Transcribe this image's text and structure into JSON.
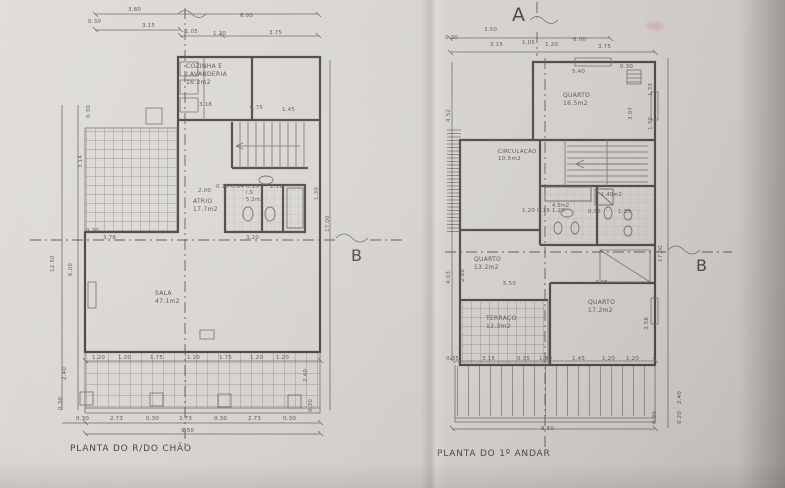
{
  "left_plan": {
    "title": "PLANTA DO R/DO CHÃO",
    "rooms": {
      "cozinha": {
        "name1": "COZINHA E",
        "name2": "LAVANDERIA",
        "area": "16.2m2"
      },
      "atrio": {
        "name1": "ATRIO",
        "area": "17.7m2"
      },
      "sala": {
        "name1": "SALA",
        "area": "47.1m2"
      },
      "instalacao_sanitaria": {
        "name1": "I.S.",
        "area": "5.2m2"
      }
    },
    "dims": [
      {
        "t": "3.80",
        "x": 128,
        "y": 7
      },
      {
        "t": "0.30",
        "x": 88,
        "y": 19
      },
      {
        "t": "3.15",
        "x": 142,
        "y": 23
      },
      {
        "t": "6.00",
        "x": 240,
        "y": 13
      },
      {
        "t": "1.05",
        "x": 185,
        "y": 29
      },
      {
        "t": "1.20",
        "x": 213,
        "y": 31
      },
      {
        "t": "3.75",
        "x": 269,
        "y": 30
      },
      {
        "t": "3.18",
        "x": 199,
        "y": 102
      },
      {
        "t": "0.75",
        "x": 250,
        "y": 105
      },
      {
        "t": "1.45",
        "x": 282,
        "y": 107
      },
      {
        "t": "2.00",
        "x": 198,
        "y": 188
      },
      {
        "t": "0.15 0.84 0.15",
        "x": 216,
        "y": 184
      },
      {
        "t": "2.16",
        "x": 270,
        "y": 184
      },
      {
        "t": "1.30",
        "x": 314,
        "y": 200,
        "r": -90
      },
      {
        "t": "3.78",
        "x": 103,
        "y": 235
      },
      {
        "t": "3.20",
        "x": 246,
        "y": 235
      },
      {
        "t": "0.30",
        "x": 86,
        "y": 228
      },
      {
        "t": "0.30",
        "x": 86,
        "y": 118,
        "r": -90
      },
      {
        "t": "3.14",
        "x": 78,
        "y": 168,
        "r": -90
      },
      {
        "t": "12.50",
        "x": 50,
        "y": 272,
        "r": -90
      },
      {
        "t": "6.00",
        "x": 68,
        "y": 276,
        "r": -90
      },
      {
        "t": "17.00",
        "x": 325,
        "y": 232,
        "r": -90
      },
      {
        "t": "1.20",
        "x": 92,
        "y": 355
      },
      {
        "t": "1.20",
        "x": 118,
        "y": 355
      },
      {
        "t": "1.75",
        "x": 150,
        "y": 355
      },
      {
        "t": "1.20",
        "x": 187,
        "y": 355
      },
      {
        "t": "1.75",
        "x": 219,
        "y": 355
      },
      {
        "t": "1.20",
        "x": 250,
        "y": 355
      },
      {
        "t": "1.20",
        "x": 276,
        "y": 355
      },
      {
        "t": "2.40",
        "x": 62,
        "y": 380,
        "r": -90
      },
      {
        "t": "0.30",
        "x": 58,
        "y": 410,
        "r": -90
      },
      {
        "t": "2.40",
        "x": 303,
        "y": 382,
        "r": -90
      },
      {
        "t": "0.30",
        "x": 308,
        "y": 412,
        "r": -90
      },
      {
        "t": "0.30",
        "x": 76,
        "y": 416
      },
      {
        "t": "2.73",
        "x": 110,
        "y": 416
      },
      {
        "t": "0.30",
        "x": 146,
        "y": 416
      },
      {
        "t": "2.73",
        "x": 179,
        "y": 416
      },
      {
        "t": "0.30",
        "x": 214,
        "y": 416
      },
      {
        "t": "2.73",
        "x": 248,
        "y": 416
      },
      {
        "t": "0.30",
        "x": 283,
        "y": 416
      },
      {
        "t": "9.50",
        "x": 181,
        "y": 428
      }
    ]
  },
  "right_plan": {
    "title": "PLANTA DO 1º ANDAR",
    "rooms": {
      "quarto_1": {
        "name1": "QUARTO",
        "area": "16.5m2"
      },
      "circulacao": {
        "name1": "CIRCULAÇÃO",
        "area": "10.5m2"
      },
      "quarto_2": {
        "name1": "QUARTO",
        "area": "13.2m2"
      },
      "quarto_3": {
        "name1": "QUARTO",
        "area": "17.2m2"
      },
      "terraco": {
        "name1": "TERRAÇO",
        "area": "12.3m2"
      },
      "is_1": {
        "area": "4.0m2"
      },
      "is_2": {
        "area": "1.40m2"
      }
    },
    "dims": [
      {
        "t": "3.50",
        "x": 484,
        "y": 27
      },
      {
        "t": "0.30",
        "x": 445,
        "y": 35
      },
      {
        "t": "3.15",
        "x": 490,
        "y": 42
      },
      {
        "t": "1.05",
        "x": 522,
        "y": 40
      },
      {
        "t": "1.20",
        "x": 545,
        "y": 42
      },
      {
        "t": "6.00",
        "x": 573,
        "y": 37
      },
      {
        "t": "3.75",
        "x": 598,
        "y": 44
      },
      {
        "t": "5.40",
        "x": 572,
        "y": 69
      },
      {
        "t": "0.30",
        "x": 620,
        "y": 64
      },
      {
        "t": "1.33",
        "x": 648,
        "y": 96,
        "r": -90
      },
      {
        "t": "3.07",
        "x": 628,
        "y": 120,
        "r": -90
      },
      {
        "t": "1.30",
        "x": 648,
        "y": 130,
        "r": -90
      },
      {
        "t": "4.52",
        "x": 446,
        "y": 122,
        "r": -90
      },
      {
        "t": "4.03",
        "x": 446,
        "y": 284,
        "r": -90
      },
      {
        "t": "2.88",
        "x": 460,
        "y": 282,
        "r": -90
      },
      {
        "t": "5.50",
        "x": 503,
        "y": 281
      },
      {
        "t": "3.35",
        "x": 595,
        "y": 280
      },
      {
        "t": "3.58",
        "x": 644,
        "y": 330,
        "r": -90
      },
      {
        "t": "1.20 0.15 1.20",
        "x": 522,
        "y": 208
      },
      {
        "t": "0.95",
        "x": 588,
        "y": 209
      },
      {
        "t": "1.35",
        "x": 618,
        "y": 209
      },
      {
        "t": "17.00",
        "x": 658,
        "y": 262,
        "r": -90
      },
      {
        "t": "0.35",
        "x": 446,
        "y": 356
      },
      {
        "t": "3.15",
        "x": 482,
        "y": 356
      },
      {
        "t": "0.35",
        "x": 517,
        "y": 356
      },
      {
        "t": "1.80",
        "x": 539,
        "y": 356
      },
      {
        "t": "1.45",
        "x": 572,
        "y": 356
      },
      {
        "t": "1.20",
        "x": 602,
        "y": 356
      },
      {
        "t": "1.20",
        "x": 626,
        "y": 356
      },
      {
        "t": "2.40",
        "x": 677,
        "y": 404,
        "r": -90
      },
      {
        "t": "0.30",
        "x": 652,
        "y": 424,
        "r": -90
      },
      {
        "t": "0.20",
        "x": 677,
        "y": 424,
        "r": -90
      },
      {
        "t": "9.50",
        "x": 541,
        "y": 426
      }
    ]
  },
  "section_markers": {
    "a": "A",
    "b_left": "B",
    "b_right": "B"
  }
}
